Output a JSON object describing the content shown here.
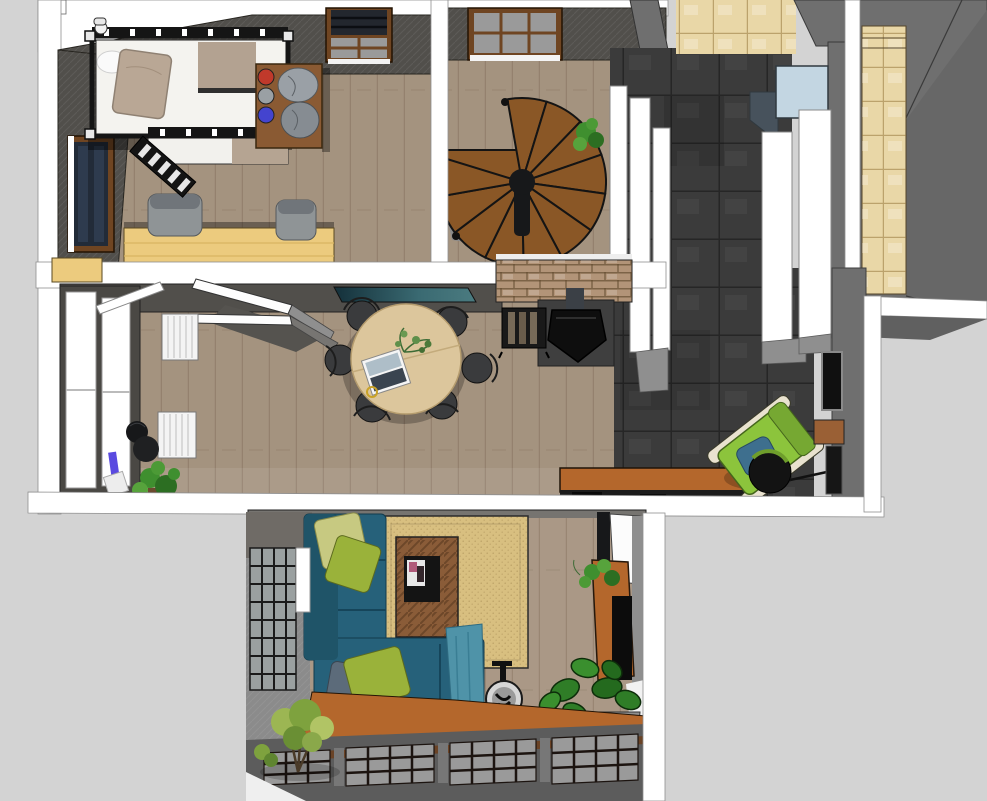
{
  "canvas": {
    "width": 987,
    "height": 801,
    "background": "#d3d3d3",
    "view": "top-down 3D dollhouse render of an apartment"
  },
  "palette": {
    "canvas_bg": "#d3d3d3",
    "wall_white": "#ffffff",
    "wall_gray": "#6f6f6f",
    "wall_dark": "#514f4b",
    "floor_taupe": "#a4937f",
    "floor_living": "#aa9886",
    "maple": "#eccb7e",
    "tile_charcoal": "#3b3b3b",
    "tile_beige": "#e9d7a7",
    "brick": "#b29478",
    "stair_wood": "#8a5726",
    "table_oak": "#dcc69c",
    "sofa_teal": "#26617a",
    "throw_teal": "#4f93a8",
    "pillow_olive": "#9ab23a",
    "pillow_lime": "#c7c981",
    "pillow_slate": "#5c6b7a",
    "rug_tan": "#d8bf80",
    "wood_orange": "#b4672c",
    "chair_green": "#8cc43c",
    "cushion_blue": "#3e6f8e",
    "sink_blue": "#c3d6e2",
    "plant_green": "#3f8f2f",
    "glass_gray": "#9a9a9a",
    "frame_brown": "#6f4522",
    "stove_black": "#0e0e0e"
  },
  "scene": {
    "description": "overhead 3d floor plan render",
    "rooms": [
      {
        "id": "bedroom",
        "items": [
          "loft-bed",
          "bed-ladder",
          "pillow",
          "dresser",
          "helmets",
          "storage-bags",
          "side-window",
          "roof-window",
          "armchairs",
          "wood-platform"
        ]
      },
      {
        "id": "stair-hall",
        "items": [
          "spiral-staircase",
          "roof-window",
          "plant"
        ]
      },
      {
        "id": "bathroom-corridor",
        "items": [
          "charcoal-tile-floor",
          "beige-tile-floor",
          "washbasin",
          "partition-walls"
        ]
      },
      {
        "id": "side-room",
        "items": [
          "beige-tiled-wall"
        ]
      },
      {
        "id": "dining-room",
        "items": [
          "round-dining-table",
          "dining-chairs",
          "table-plant",
          "tablet",
          "french-windows",
          "radiators",
          "coat-stand",
          "floor-plant",
          "wood-stove",
          "stove-pipe",
          "log-rack",
          "brick-chimney",
          "glass-counter",
          "open-doors",
          "lounge-chair",
          "ottoman",
          "wall-frames",
          "side-desk",
          "wood-bench"
        ]
      },
      {
        "id": "living-room",
        "items": [
          "sectional-sofa",
          "cushions",
          "throw-blanket",
          "sisal-rug",
          "coffee-table",
          "magazine-tray",
          "side-table",
          "tv-sideboard",
          "tv",
          "monstera-plant",
          "small-plant",
          "indoor-tree",
          "industrial-windows",
          "doorway"
        ]
      }
    ]
  }
}
